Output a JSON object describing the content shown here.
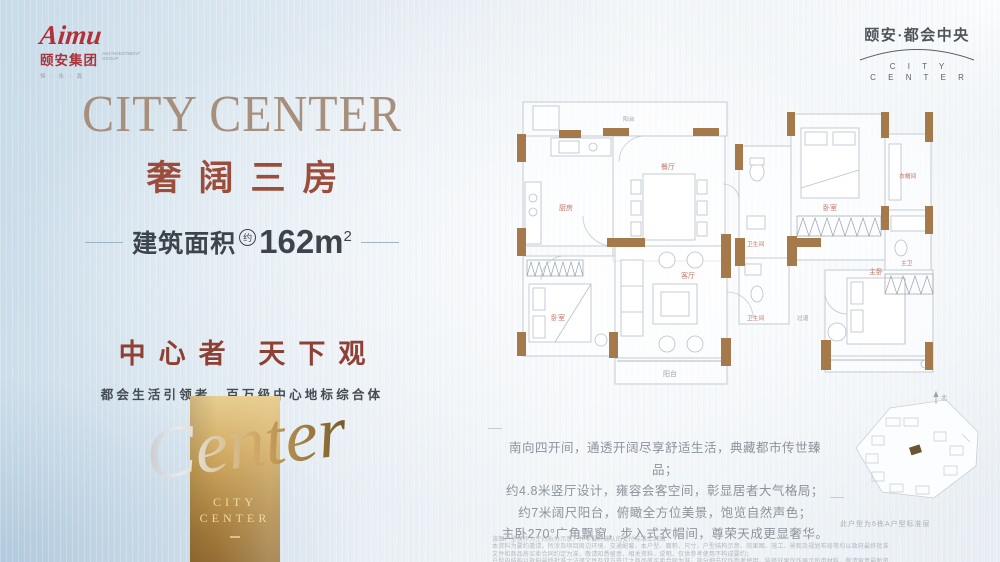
{
  "colors": {
    "accent_red": "#9c4c3a",
    "title_taupe": "#a68f7c",
    "slogan_red": "#8d4033",
    "gold_dark": "#8a6430",
    "gold_light": "#ecd49a",
    "wall_brown": "#a5794a",
    "text_dark": "#3d444c",
    "text_gray": "#8d939c"
  },
  "brand": {
    "logo_script": "Aimu",
    "logo_name": "颐安集团",
    "logo_sub_line1": "AIM INVESTMENT",
    "logo_sub_line2": "GROUP",
    "logo_tagline": "恒 · 永 · 真"
  },
  "project": {
    "name_cn": "颐安·都会中央",
    "en_line1": "C I T Y",
    "en_line2": "C E N T E R"
  },
  "hero": {
    "title": "CITY CENTER",
    "subtitle": "奢阔三房",
    "area_label": "建筑面积",
    "area_circle": "约",
    "area_value": "162m",
    "area_sup": "2",
    "slogan": "中心者 天下观",
    "subslogan": "都会生活引领者　百万级中心地标综合体"
  },
  "goldcard": {
    "script": "Center",
    "line1": "CITY",
    "line2": "CENTER"
  },
  "floorplan": {
    "rooms": {
      "hall": "阳台",
      "kitchen": "厨房",
      "dining": "餐厅",
      "bath1": "卫生间",
      "bedroom2": "卧室",
      "closet": "衣帽间",
      "master_bath": "主卫",
      "bedroom3": "卧室",
      "living": "客厅",
      "balcony": "阳台",
      "corridor": "过道",
      "bath2": "卫生间",
      "master": "主卧"
    }
  },
  "features": {
    "lines": [
      "南向四开间，通透开阔尽享舒适生活，典藏都市传世臻品；",
      "约4.8米竖厅设计，雍容会客空间，彰显居者大气格局；",
      "约7米阔尺阳台，俯瞰全方位美景，饱览自然声色；",
      "主卧270°广角飘窗，步入式衣帽间，尊荣天成更显奢华。"
    ]
  },
  "siteplan": {
    "north": "北",
    "caption": "此户型为6栋A户型标准层"
  },
  "disclaimer": {
    "lines": [
      "该图户型仅作为空间拆分示意，并非最终确认的交付标准工具图",
      "本资料为要约邀请，所涉及项目周边环境、交通配套、本户型、面积、尺寸、户型结构示意、效果图、施工、景观及规划布局等均以政府最终批准文件和商品房买卖合同约定为准，敬请知悉留意，相关资料、说明，仅供参考使用不构成要约；",
      "户型内结构以政府最终批准之法律文件及双方签订之商品房买卖合同为准，部分细节仅作参考使用，装修效果仅作展示所用材料，敬请留意最新资料。"
    ]
  }
}
